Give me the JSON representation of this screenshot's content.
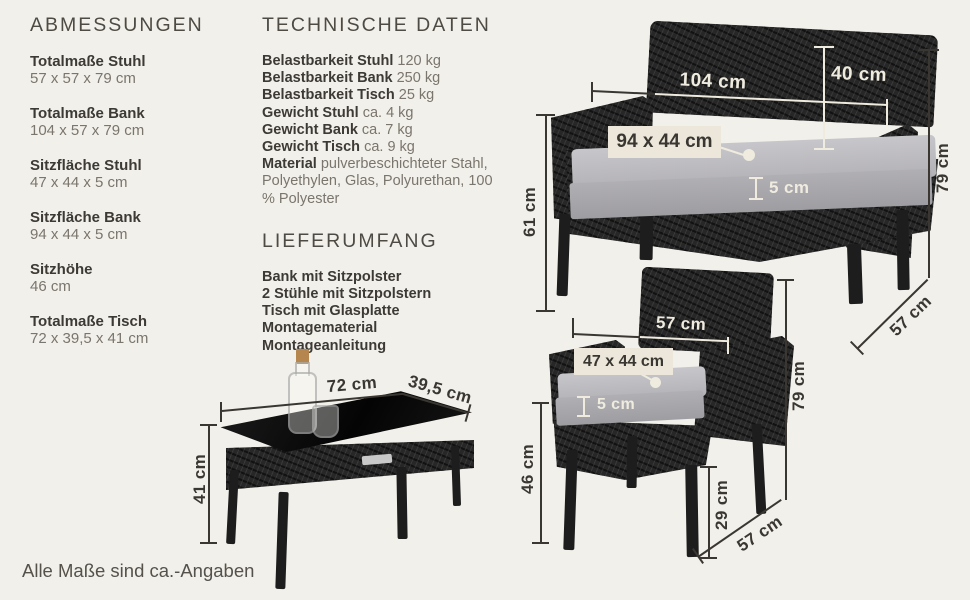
{
  "abmessungen": {
    "title": "ABMESSUNGEN",
    "items": [
      {
        "label": "Totalmaße Stuhl",
        "value": "57 x 57 x 79 cm"
      },
      {
        "label": "Totalmaße Bank",
        "value": "104 x 57 x 79 cm"
      },
      {
        "label": "Sitzfläche Stuhl",
        "value": "47 x 44 x 5 cm"
      },
      {
        "label": "Sitzfläche Bank",
        "value": "94 x 44 x 5 cm"
      },
      {
        "label": "Sitzhöhe",
        "value": "46 cm"
      },
      {
        "label": "Totalmaße Tisch",
        "value": "72 x 39,5 x 41 cm"
      }
    ]
  },
  "technische_daten": {
    "title": "TECHNISCHE DATEN",
    "items": [
      {
        "label": "Belastbarkeit Stuhl",
        "value": "120 kg"
      },
      {
        "label": "Belastbarkeit Bank",
        "value": "250 kg"
      },
      {
        "label": "Belastbarkeit Tisch",
        "value": "25 kg"
      },
      {
        "label": "Gewicht Stuhl",
        "value": "ca. 4 kg"
      },
      {
        "label": "Gewicht Bank",
        "value": "ca. 7 kg"
      },
      {
        "label": "Gewicht Tisch",
        "value": "ca. 9 kg"
      },
      {
        "label": "Material",
        "value": "pulverbeschichteter Stahl, Polyethylen, Glas, Polyurethan, 100 % Polyester"
      }
    ]
  },
  "lieferumfang": {
    "title": "LIEFERUMFANG",
    "items": [
      "Bank mit Sitzpolster",
      "2 Stühle mit Sitzpolstern",
      "Tisch mit Glasplatte",
      "Montagematerial",
      "Montageanleitung"
    ]
  },
  "footer": {
    "note": "Alle Maße sind ca.-Angaben"
  },
  "diagram": {
    "bench": {
      "width": "104 cm",
      "back_height": "40 cm",
      "cushion": "94 x 44 cm",
      "cushion_thickness": "5 cm",
      "armrest_height": "61 cm",
      "total_height": "79 cm",
      "depth": "57 cm"
    },
    "chair": {
      "width": "57 cm",
      "cushion": "47 x 44 cm",
      "cushion_thickness": "5 cm",
      "seat_height": "46 cm",
      "leg_height": "29 cm",
      "total_height": "79 cm",
      "depth": "57 cm"
    },
    "table": {
      "width": "72 cm",
      "depth": "39,5 cm",
      "height": "41 cm"
    }
  },
  "colors": {
    "background": "#f2f0ea",
    "text_dark": "#3d3a35",
    "text_muted": "#7a756d",
    "annotation_dark": "#3a3732",
    "annotation_light": "#efebdf",
    "label_box_bg": "#ece7da",
    "furniture": "#272727",
    "cushion": "#b7b6ba"
  }
}
